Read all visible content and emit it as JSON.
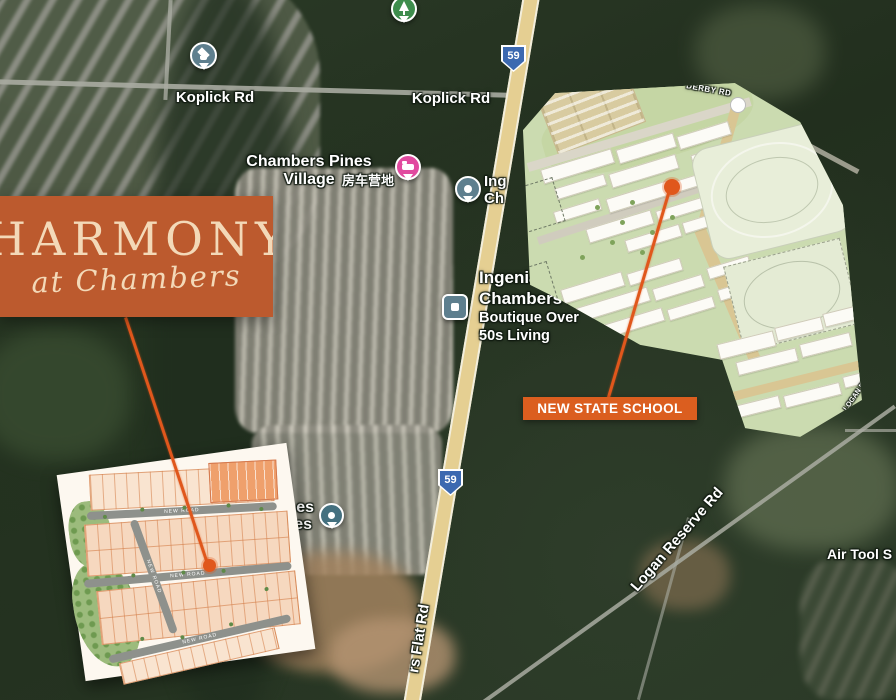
{
  "logo": {
    "title": "HARMONY",
    "subtitle": "at Chambers"
  },
  "school_annotation": {
    "label": "NEW STATE SCHOOL"
  },
  "road_labels": {
    "koplick_left": "Koplick Rd",
    "koplick_right": "Koplick Rd",
    "chambers_flat": "rs Flat Rd",
    "logan_reserve": "Logan Reserve Rd",
    "derby_rd": "DERBY RD",
    "logan_reserve_plan": "LOGAN RESERVE RD",
    "air_tool": "Air Tool S"
  },
  "route_shields": {
    "value": "59"
  },
  "pois": {
    "village": {
      "name": "Chambers Pines Village",
      "name_cn": "房车营地"
    },
    "ingenia_partial": {
      "line1": "Ing",
      "line2": "Ch"
    },
    "ingenia": {
      "line1": "Ingenia Lifestyle",
      "line2": "Chambers Pines",
      "line3": "Boutique Over",
      "line4": "50s Living"
    },
    "occluded": {
      "line1": "es",
      "line2": "es"
    }
  },
  "siteplan_inset": {
    "road_label": "NEW ROAD"
  },
  "colors": {
    "accent_orange": "#E0571C",
    "logo_bg": "#BC5A2E",
    "callout_bg": "#DB5E1F",
    "shield_blue": "#3C69B0"
  }
}
